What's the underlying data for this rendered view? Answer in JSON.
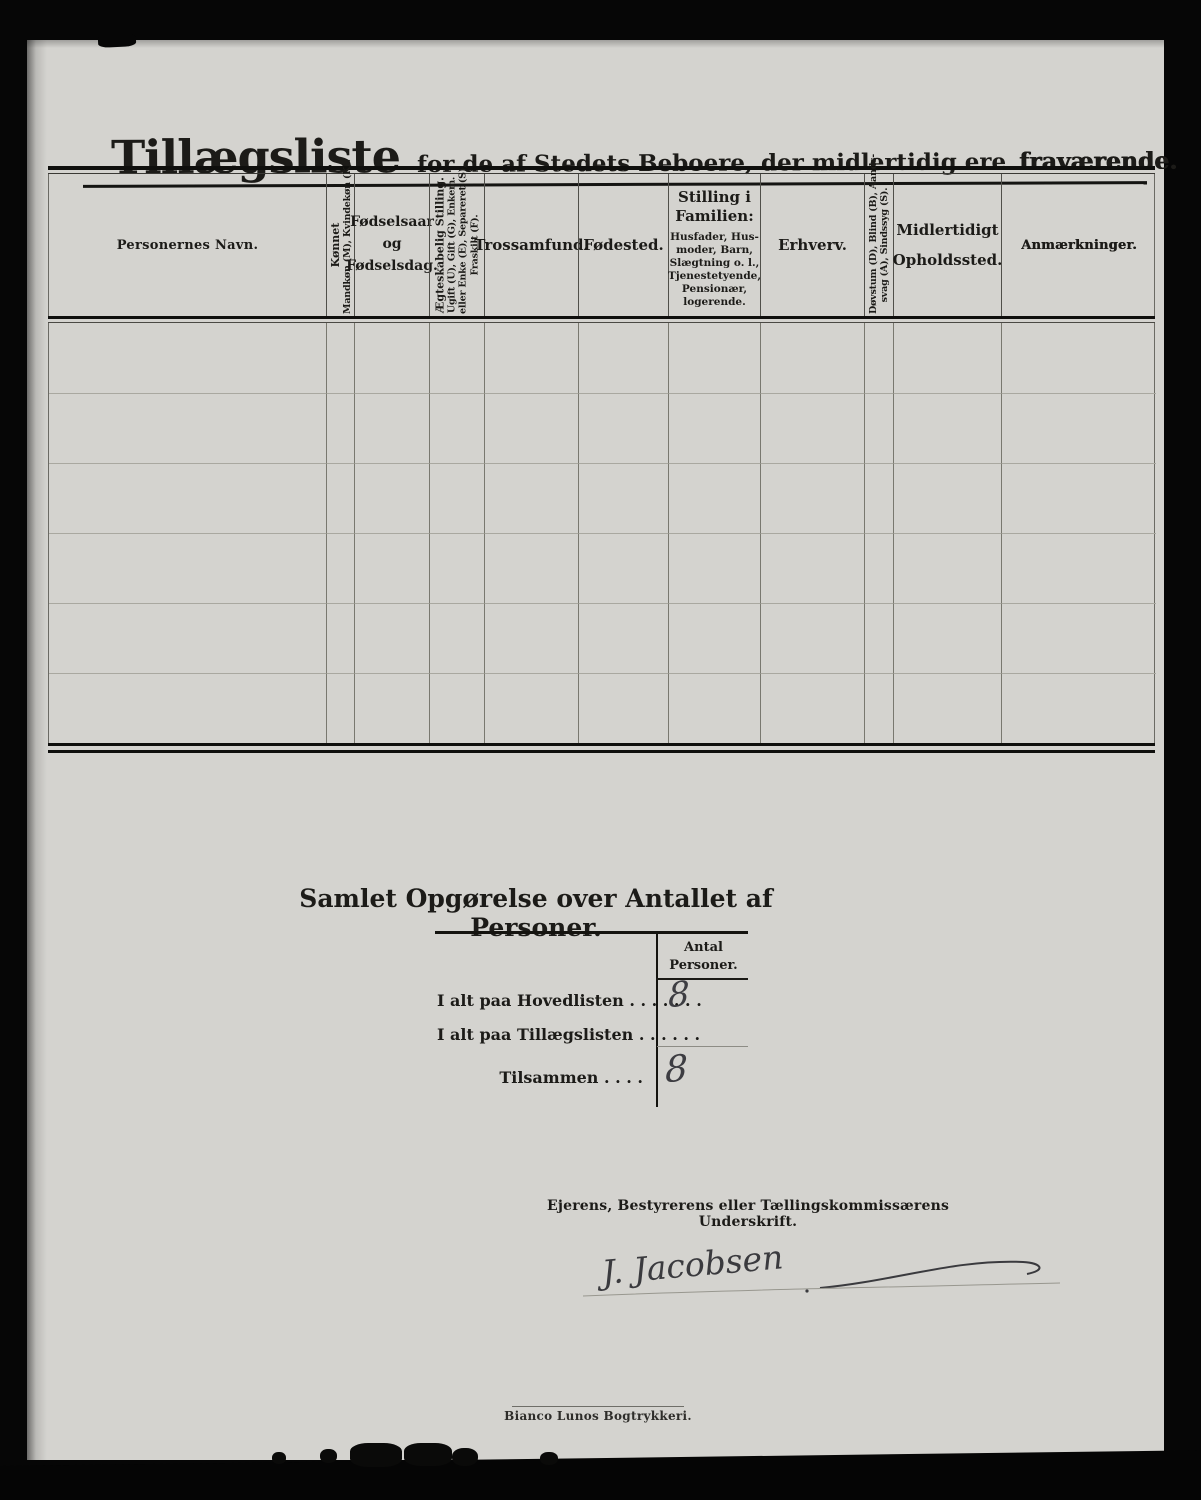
{
  "title": {
    "main": "Tillægsliste",
    "subtitle": "for de af Stedets Beboere, der midlertidig ere",
    "emphasis": "fraværende."
  },
  "table": {
    "body_rows": 6,
    "headers": {
      "navn": "Personernes Navn.",
      "koennet": [
        "Kønnet",
        "Mandkøn (M), Kvindekøn (K)."
      ],
      "foedselsaar": [
        "Fødselsaar",
        "og",
        "Fødselsdag."
      ],
      "aegteskabelig": [
        "Ægteskabelig Stilling.",
        "Ugift (U), Gift (G), Enkem.",
        "eller Enke (E), Separeret (S),",
        "Fraskilt (F)."
      ],
      "trossamfund": "Trossamfund.",
      "foedested": "Fødested.",
      "stilling": [
        "Stilling i",
        "Familien:",
        "Husfader, Hus-",
        "moder, Barn,",
        "Slægtning o. l.,",
        "Tjenestetyende,",
        "Pensionær,",
        "logerende."
      ],
      "erhverv": "Erhverv.",
      "doevstum": [
        "Døvstum (D), Blind (B), Aands-",
        "svag (A), Sindssyg (S)."
      ],
      "midlertidigt": [
        "Midlertidigt",
        "Opholdssted."
      ],
      "anmaerkninger": "Anmærkninger."
    }
  },
  "summary": {
    "title": "Samlet Opgørelse over Antallet af Personer.",
    "col_header": [
      "Antal",
      "Personer."
    ],
    "rows": [
      {
        "label": "I alt paa Hovedlisten . . . . . . .",
        "value": "8"
      },
      {
        "label": "I alt paa Tillægslisten  . . . . . .",
        "value": ""
      },
      {
        "label": "Tilsammen . . . .",
        "value": "8"
      }
    ]
  },
  "signature": {
    "label": "Ejerens, Bestyrerens eller Tællingskommissærens Underskrift.",
    "name": "J. Jacobsen"
  },
  "footer": {
    "printer": "Bianco Lunos Bogtrykkeri."
  },
  "colors": {
    "paper": "#d4d3cf",
    "ink": "#1c1b18",
    "handwriting_ink": "#3d3d42"
  }
}
